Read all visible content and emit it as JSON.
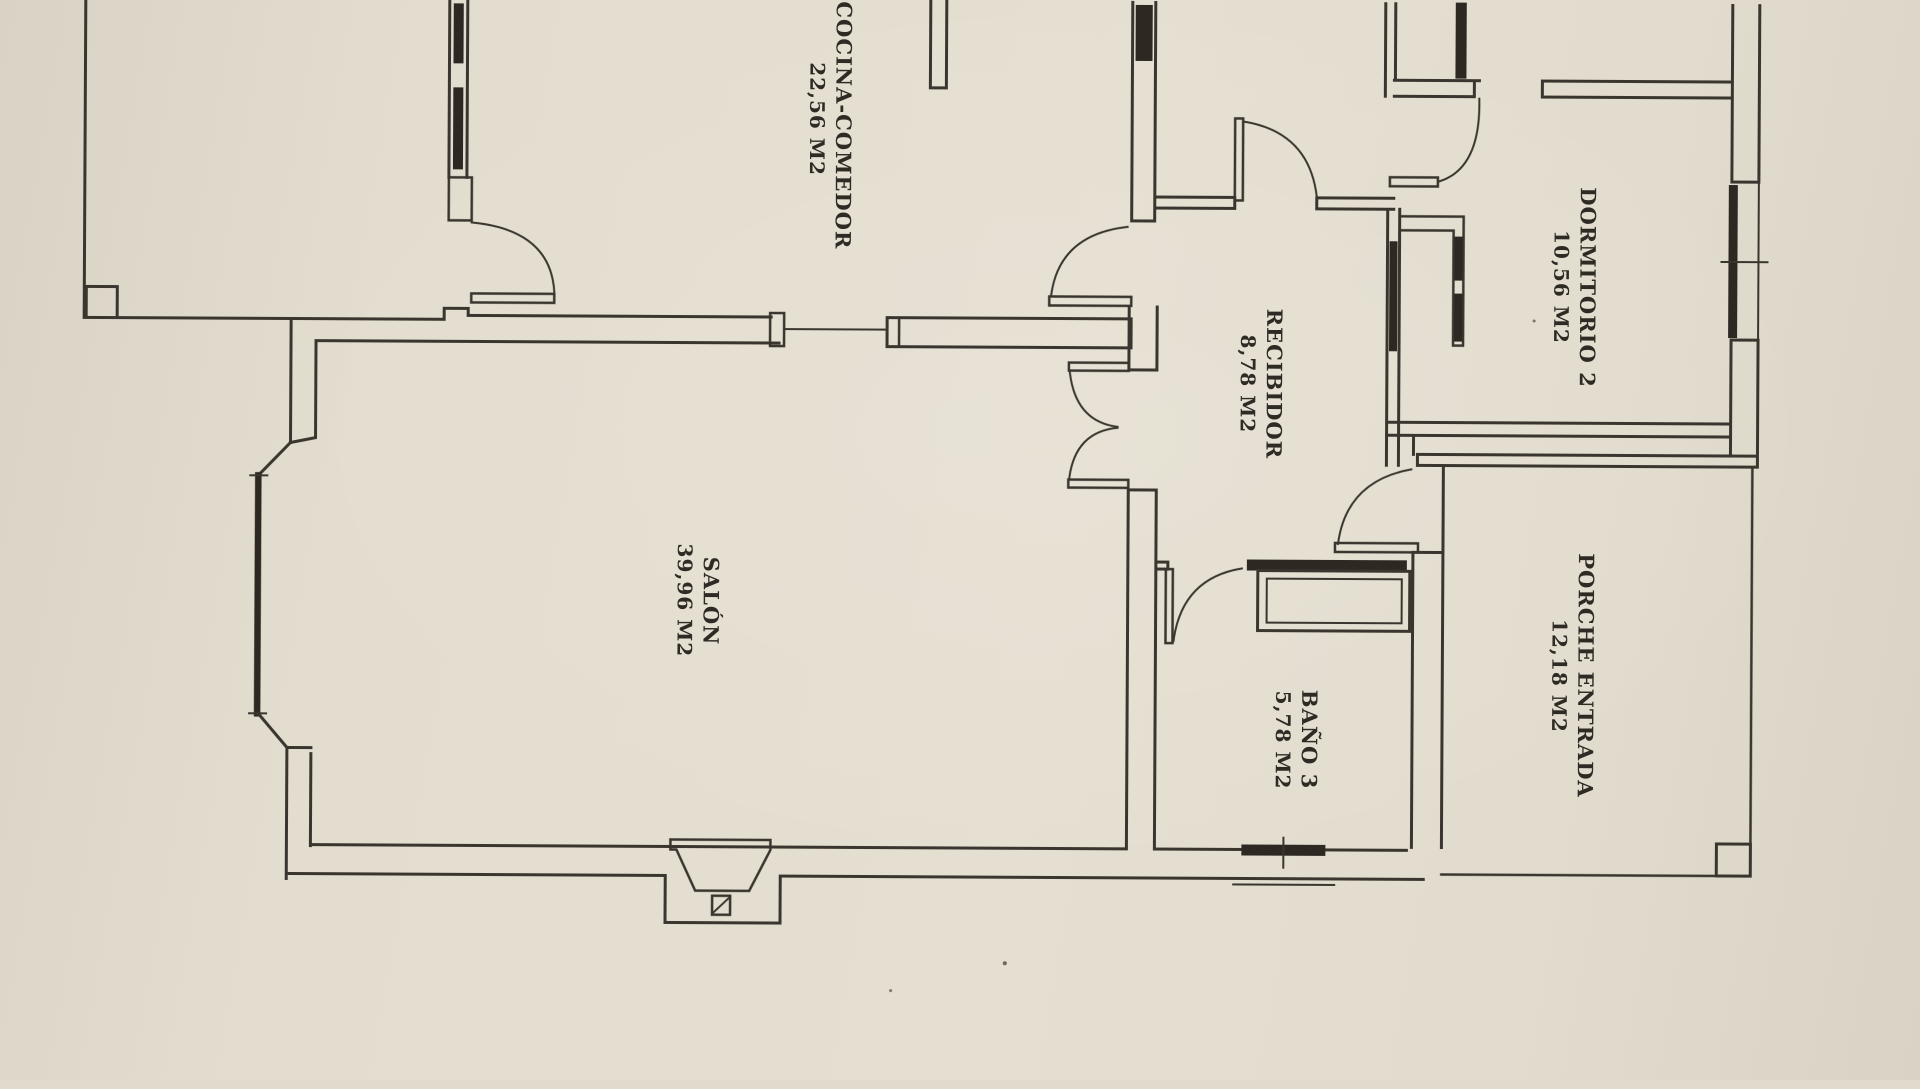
{
  "plan": {
    "rooms": [
      {
        "name": "COCINA-COMEDOR",
        "area": "22,56 M2"
      },
      {
        "name": "RECIBIDOR",
        "area": "8,78 M2"
      },
      {
        "name": "DORMITORIO 2",
        "area": "10,56 M2"
      },
      {
        "name": "SALÓN",
        "area": "39,96 M2"
      },
      {
        "name": "PORCHE ENTRADA",
        "area": "12,18 M2"
      },
      {
        "name": "BAÑO 3",
        "area": "5,78 M2"
      }
    ],
    "colors": {
      "paper": "#e3ddcf",
      "ink": "#3a352e",
      "window_fill": "#2d2822"
    },
    "symbols": [
      "door-swing-arc",
      "window-bar",
      "wall-footing-square",
      "entrance-step",
      "drain-square"
    ]
  }
}
